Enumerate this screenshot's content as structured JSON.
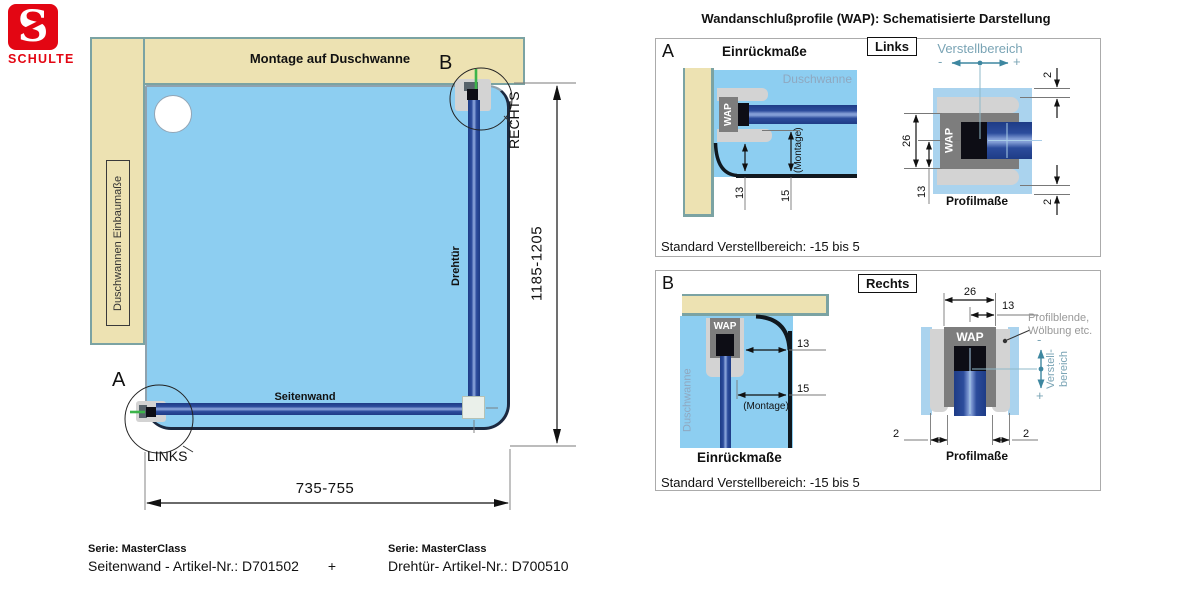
{
  "logo": {
    "letter": "S",
    "brand": "SCHULTE"
  },
  "main": {
    "montage": "Montage auf Duschwanne",
    "einbau": "Duschwannen Einbaumaße",
    "seitenwand": "Seitenwand",
    "drehtuer": "Drehtür",
    "detail_a": "A",
    "detail_b": "B",
    "links": "LINKS",
    "rechts": "RECHTS",
    "dim_width": "735-755",
    "dim_height": "1185-1205"
  },
  "wap": {
    "title": "Wandanschlußprofile (WAP): Schematisierte Darstellung",
    "a": {
      "id": "A",
      "tag": "Links",
      "einrueck": "Einrückmaße",
      "duschwanne": "Duschwanne",
      "wap": "WAP",
      "d13": "13",
      "d15": "15",
      "montage": "(Montage)",
      "verstellbereich": "Verstellbereich",
      "minus": "-",
      "plus": "+",
      "d26": "26",
      "d13b": "13",
      "d2_top": "2",
      "d2_bottom": "2",
      "profilmasse": "Profilmaße",
      "note": "Standard Verstellbereich: -15 bis 5"
    },
    "b": {
      "id": "B",
      "tag": "Rechts",
      "duschwanne": "Duschwanne",
      "wap": "WAP",
      "d13": "13",
      "d15": "15",
      "montage": "(Montage)",
      "einrueck": "Einrückmaße",
      "d26": "26",
      "d13b": "13",
      "d2_left": "2",
      "d2_right": "2",
      "profilblende_1": "Profilblende,",
      "profilblende_2": "Wölbung etc.",
      "verstell_1": "Verstell-",
      "verstell_2": "bereich",
      "minus": "-",
      "plus": "+",
      "profilmasse": "Profilmaße",
      "note": "Standard Verstellbereich: -15 bis 5"
    }
  },
  "footer": {
    "serie_left": "Serie: MasterClass",
    "article_left": "Seitenwand - Artikel-Nr.: D701502",
    "plus": "+",
    "serie_right": "Serie: MasterClass",
    "article_right": "Drehtür- Artikel-Nr.: D700510"
  },
  "colors": {
    "brand_red": "#e30613",
    "wall_beige": "#ede2b2",
    "tray_blue": "#8dcef1",
    "glass_navy": "#2c4c9c",
    "profile_gray": "#7d7d7d",
    "accent_teal": "#3e87a0",
    "marker_green": "#3cb44a"
  }
}
